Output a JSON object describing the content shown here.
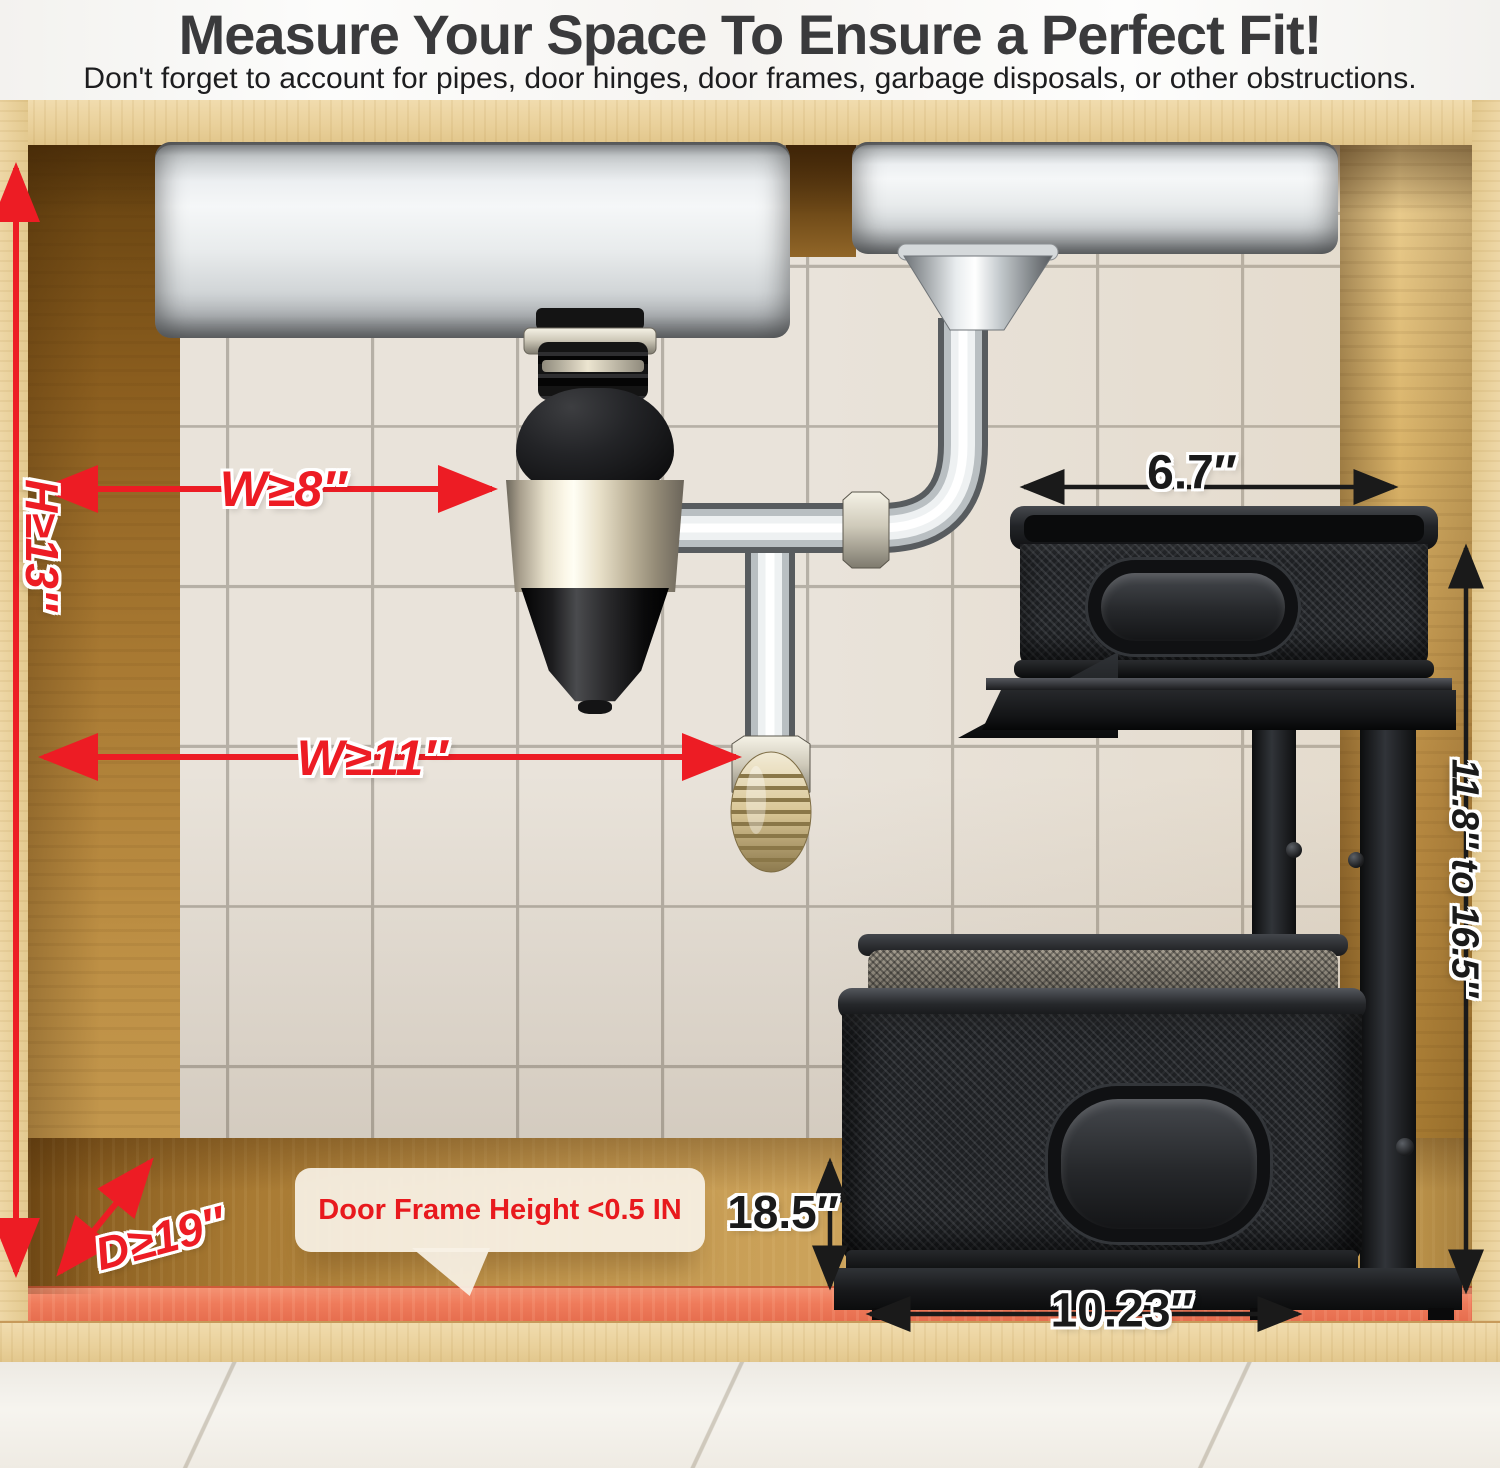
{
  "header": {
    "title": "Measure Your Space To Ensure a Perfect Fit!",
    "subtitle": "Don't forget to account for pipes, door hinges, door frames, garbage disposals, or other obstructions."
  },
  "annotations": {
    "width_min": "W≥8″",
    "height_min": "H≥13″",
    "pipe_width_min": "W≥11″",
    "depth_min": "D≥19″",
    "top_basket_depth": "6.7″",
    "rack_height_range": "11.8″ to 16.5″",
    "door_frame_note": "Door Frame Height <0.5 IN",
    "basket_height": "18.5″",
    "basket_width": "10.23″"
  },
  "colors": {
    "annotation_red": "#ed1c24",
    "annotation_black": "#1a1a1a",
    "clearance_strip_orange": "#ee7a57",
    "cabinet_wood_light": "#e9d09a",
    "cabinet_wood_medium": "#b07f3a"
  }
}
